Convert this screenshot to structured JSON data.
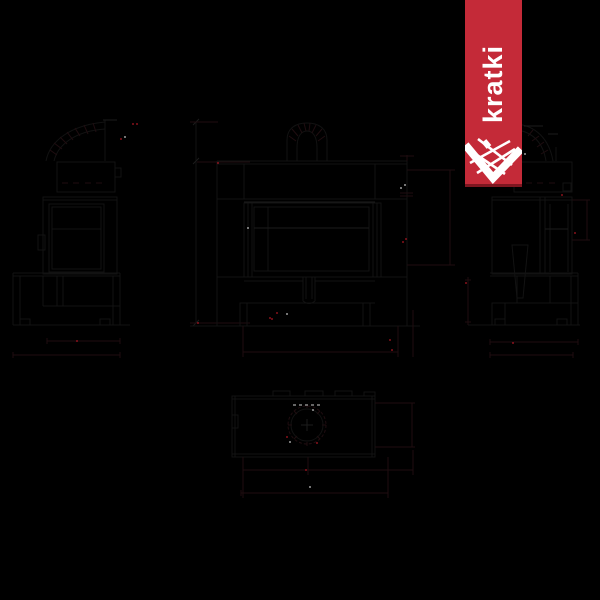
{
  "canvas": {
    "width": 600,
    "height": 600,
    "background": "#000000"
  },
  "brand_banner": {
    "text": "kratki",
    "background_color": "#c42a38",
    "shadow_color": "#7e1620",
    "text_color": "#ffffff",
    "logo_icon": "kratki-grate-arrow"
  },
  "drawing": {
    "kind": "technical-dimension-drawing",
    "subject": "fireplace-insert",
    "views": [
      "left-side-view",
      "front-view",
      "right-side-view",
      "top-view"
    ],
    "line_color": "#121212",
    "dimension_line_color": "#1f0d10",
    "centerline_color": "#888888",
    "accent_red": "#b01724",
    "speck_white": "#c9c9c9",
    "specks": [
      {
        "x": 133,
        "y": 124,
        "c": "red"
      },
      {
        "x": 137,
        "y": 124,
        "c": "red"
      },
      {
        "x": 121,
        "y": 139,
        "c": "red"
      },
      {
        "x": 218,
        "y": 163,
        "c": "red"
      },
      {
        "x": 198,
        "y": 323,
        "c": "red"
      },
      {
        "x": 406,
        "y": 239,
        "c": "red"
      },
      {
        "x": 403,
        "y": 242,
        "c": "red"
      },
      {
        "x": 270,
        "y": 318,
        "c": "red"
      },
      {
        "x": 277,
        "y": 313,
        "c": "red"
      },
      {
        "x": 272,
        "y": 319,
        "c": "red"
      },
      {
        "x": 390,
        "y": 340,
        "c": "red"
      },
      {
        "x": 392,
        "y": 350,
        "c": "red"
      },
      {
        "x": 77,
        "y": 341,
        "c": "red"
      },
      {
        "x": 513,
        "y": 343,
        "c": "red"
      },
      {
        "x": 466,
        "y": 283,
        "c": "red"
      },
      {
        "x": 562,
        "y": 195,
        "c": "red"
      },
      {
        "x": 575,
        "y": 233,
        "c": "red"
      },
      {
        "x": 287,
        "y": 437,
        "c": "red"
      },
      {
        "x": 317,
        "y": 443,
        "c": "red"
      },
      {
        "x": 306,
        "y": 470,
        "c": "red"
      },
      {
        "x": 125,
        "y": 137,
        "c": "white"
      },
      {
        "x": 405,
        "y": 185,
        "c": "white"
      },
      {
        "x": 401,
        "y": 188,
        "c": "white"
      },
      {
        "x": 248,
        "y": 228,
        "c": "white"
      },
      {
        "x": 287,
        "y": 314,
        "c": "white"
      },
      {
        "x": 290,
        "y": 442,
        "c": "white"
      },
      {
        "x": 313,
        "y": 410,
        "c": "white"
      },
      {
        "x": 310,
        "y": 487,
        "c": "white"
      },
      {
        "x": 525,
        "y": 154,
        "c": "white"
      }
    ]
  }
}
